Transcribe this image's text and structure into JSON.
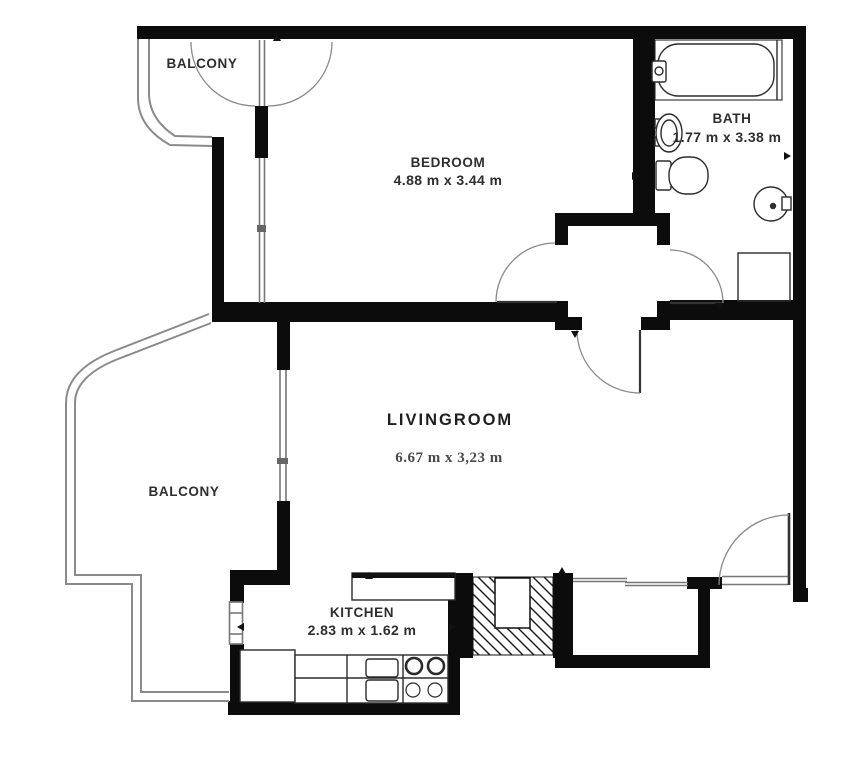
{
  "plan": {
    "type": "apartment-floor-plan",
    "rooms": {
      "balcony_top": {
        "name": "BALCONY"
      },
      "bedroom": {
        "name": "BEDROOM",
        "dims": "4.88 m x 3.44 m"
      },
      "bath": {
        "name": "BATH",
        "dims": "1.77 m x 3.38 m"
      },
      "livingroom": {
        "name": "LIVINGROOM",
        "dims": "6.67 m x 3,23 m"
      },
      "balcony_left": {
        "name": "BALCONY"
      },
      "kitchen": {
        "name": "KITCHEN",
        "dims": "2.83 m x 1.62 m"
      }
    },
    "colors": {
      "wall": "#0c0c0c",
      "fixture_line": "#2b2b2b",
      "window_line": "#777777",
      "railing": "#8a8a8a",
      "background": "#ffffff",
      "room_text": "#2e2e2e",
      "livingroom_dim_text": "#4a4a4a"
    }
  }
}
